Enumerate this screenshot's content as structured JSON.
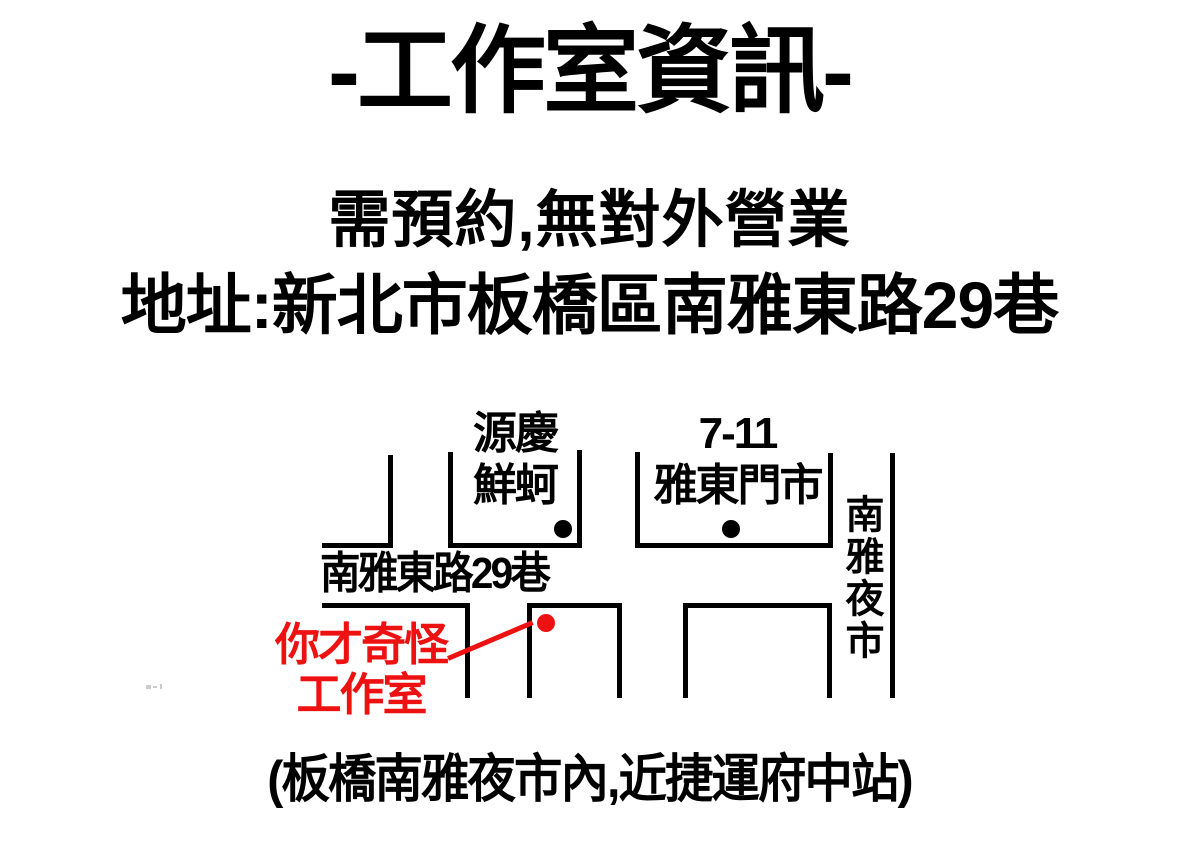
{
  "header": {
    "title": "-工作室資訊-",
    "note": "需預約,無對外營業",
    "address": "地址:新北市板橋區南雅東路29巷"
  },
  "map": {
    "landmark_oyster": {
      "line1": "源慶",
      "line2": "鮮蚵"
    },
    "landmark_711": {
      "line1": "7-11",
      "line2": "雅東門市"
    },
    "street": "南雅東路29巷",
    "night_market": "南雅夜市",
    "studio": {
      "line1": "你才奇怪",
      "line2": "工作室"
    },
    "colors": {
      "road_line": "#000000",
      "studio_accent": "#ee1111",
      "background": "#ffffff"
    }
  },
  "footer": {
    "caption": "(板橋南雅夜市內,近捷運府中站)"
  }
}
